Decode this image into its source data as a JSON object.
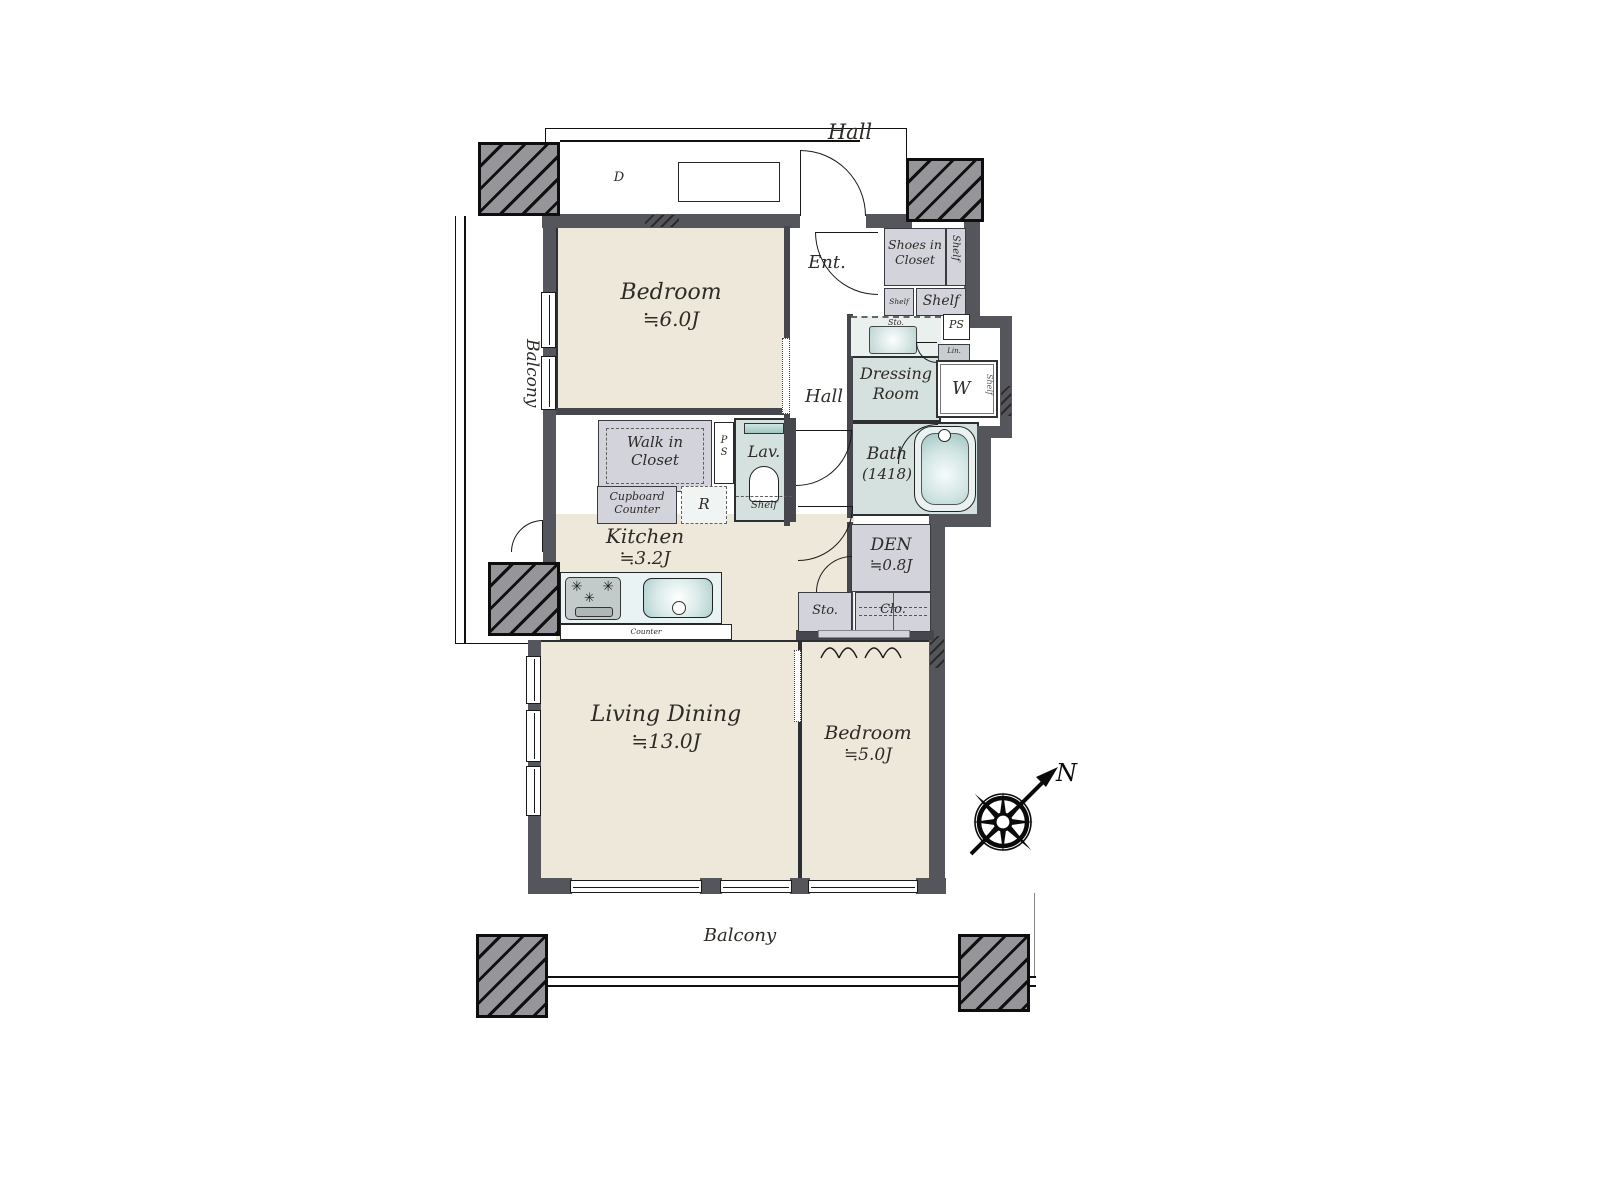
{
  "plan": {
    "common": {
      "hall_top": "Hall",
      "delivery": "D",
      "balcony_left": "Balcony",
      "balcony_bottom": "Balcony",
      "north": "N"
    },
    "entry": {
      "ent": "Ent.",
      "shoes_in_closet": "Shoes in Closet",
      "shelf_side": "Shelf",
      "shelf_small": "Shelf",
      "shelf_wide": "Shelf"
    },
    "utility": {
      "sto_laundry": "Sto.",
      "ps_top": "PS",
      "linen": "Lin.",
      "dressing1": "Dressing",
      "dressing2": "Room",
      "washer": "W",
      "washer_shelf": "Shelf",
      "bath_name": "Bath",
      "bath_size": "(1418)",
      "lav": "Lav.",
      "lav_shelf": "Shelf",
      "ps_mid_p": "P",
      "ps_mid_s": "S"
    },
    "hall_inner": "Hall",
    "storage": {
      "wic1": "Walk in",
      "wic2": "Closet",
      "cupboard1": "Cupboard",
      "cupboard2": "Counter",
      "fridge": "R",
      "counter": "Counter",
      "sto": "Sto.",
      "clo": "Clo."
    },
    "rooms": {
      "bedroom_main_name": "Bedroom",
      "bedroom_main_size": "≒6.0J",
      "kitchen_name": "Kitchen",
      "kitchen_size": "≒3.2J",
      "den_name": "DEN",
      "den_size": "≒0.8J",
      "living_name": "Living Dining",
      "living_size": "≒13.0J",
      "bedroom2_name": "Bedroom",
      "bedroom2_size": "≒5.0J"
    },
    "colors": {
      "room_beige": "#EDE8D9",
      "room_teal": "#D5E1DE",
      "storage_gray": "#D3D3DB",
      "wall_gray": "#55565B",
      "pillar_gray": "#95959A"
    }
  }
}
